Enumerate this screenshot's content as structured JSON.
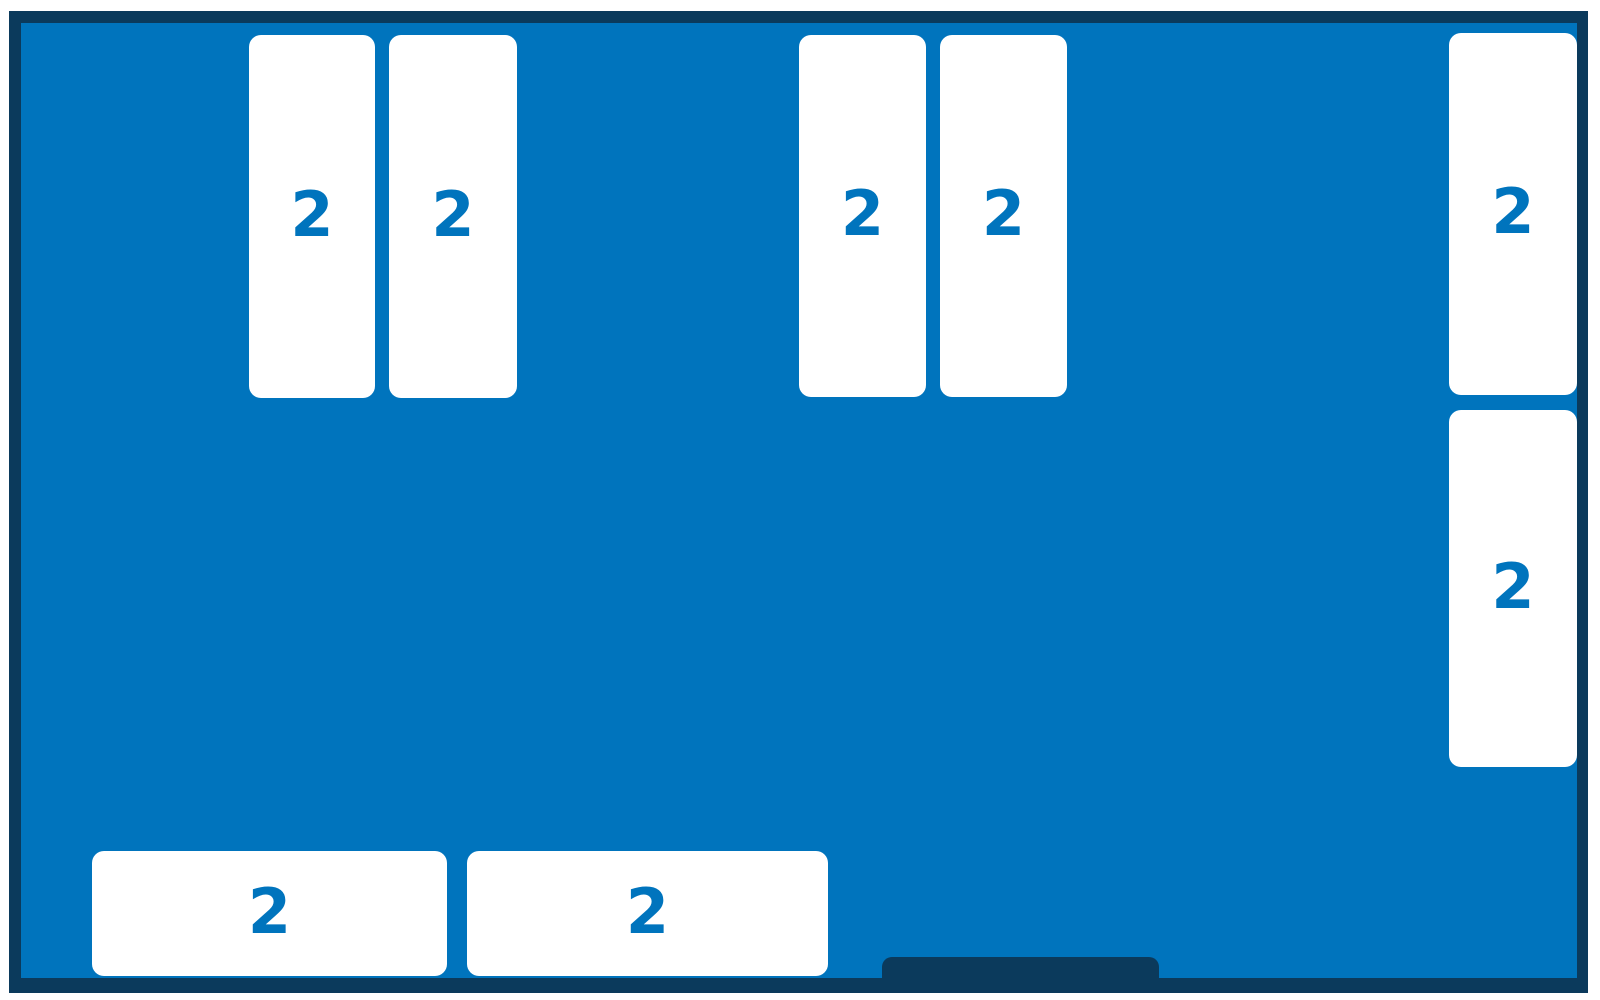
{
  "room": {
    "colors": {
      "floor": "#0074bd",
      "wall": "#0b3a5c",
      "table_fill": "#ffffff",
      "table_label": "#0074bd"
    },
    "tables": [
      {
        "name": "table-top-left-1",
        "capacity": "2"
      },
      {
        "name": "table-top-left-2",
        "capacity": "2"
      },
      {
        "name": "table-top-mid-1",
        "capacity": "2"
      },
      {
        "name": "table-top-mid-2",
        "capacity": "2"
      },
      {
        "name": "table-right-top",
        "capacity": "2"
      },
      {
        "name": "table-right-bottom",
        "capacity": "2"
      },
      {
        "name": "table-bottom-1",
        "capacity": "2"
      },
      {
        "name": "table-bottom-2",
        "capacity": "2"
      }
    ],
    "door": {
      "name": "entrance-door"
    }
  }
}
